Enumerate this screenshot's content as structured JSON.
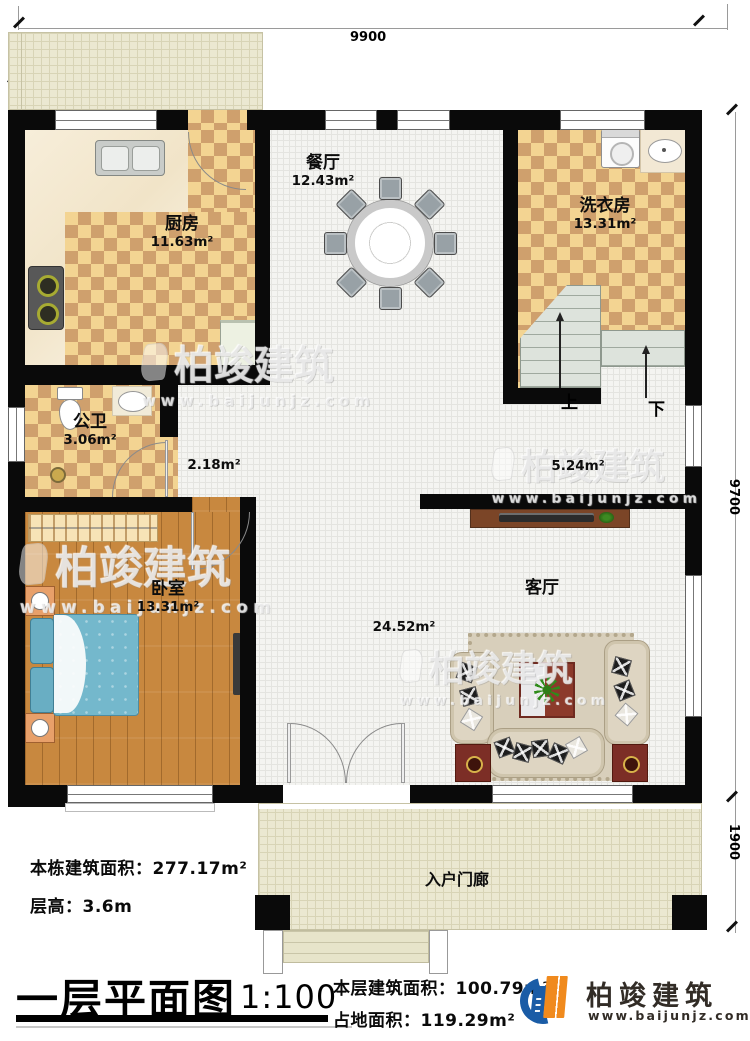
{
  "watermark": {
    "text": "柏竣建筑",
    "url": "www.baijunjz.com"
  },
  "brand": {
    "name": "柏竣建筑",
    "url": "www.baijunjz.com",
    "blue": "#1a5ca6",
    "orange": "#f08a1d"
  },
  "dimensions": {
    "top": "9900",
    "right_main": "9700",
    "right_porch": "1900"
  },
  "rooms": {
    "kitchen": {
      "name": "厨房",
      "area": "11.63m²"
    },
    "dining": {
      "name": "餐厅",
      "area": "12.43m²"
    },
    "laundry": {
      "name": "洗衣房",
      "area": "13.31m²"
    },
    "bathroom": {
      "name": "公卫",
      "area": "3.06m²"
    },
    "bedroom": {
      "name": "卧室",
      "area": "13.31m²"
    },
    "living": {
      "name": "客厅",
      "area": "24.52m²"
    },
    "porch": {
      "name": "入户门廊"
    }
  },
  "halls": {
    "west": "2.18m²",
    "stair": "5.24m²"
  },
  "stairs": {
    "up": "上",
    "down": "下"
  },
  "footer": {
    "total_building_area": "本栋建筑面积：277.17m²",
    "floor_height": "层高：3.6m",
    "title": "一层平面图",
    "scale": "1:100",
    "floor_area": "本层建筑面积：100.79m²",
    "footprint_area": "占地面积：119.29m²"
  }
}
